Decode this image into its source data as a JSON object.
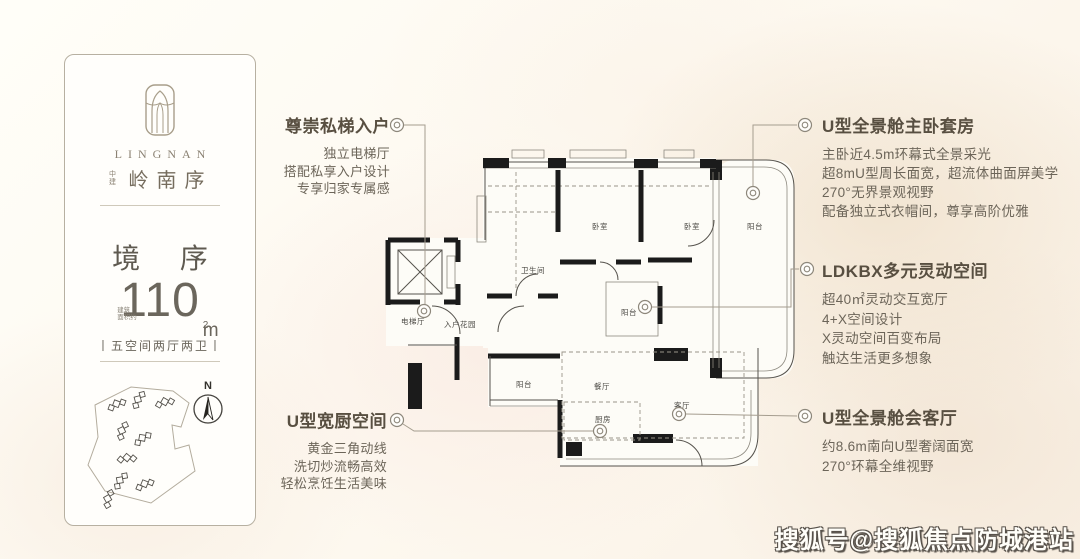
{
  "brand_card": {
    "latin_name": "LINGNAN",
    "brand_prefix": "中建",
    "brand_name": "岭南序",
    "series_title": "境 序",
    "area_note_line1": "建筑",
    "area_note_line2": "面积约",
    "area_value": "110",
    "area_unit_letter": "m",
    "area_unit_exp": "2",
    "layout_spec": "丨五空间两厅两卫丨",
    "compass_label": "N"
  },
  "callouts": {
    "private_elevator": {
      "title": "尊崇私梯入户",
      "lines": [
        "独立电梯厅",
        "搭配私享入户设计",
        "专享归家专属感"
      ]
    },
    "master_suite": {
      "title": "U型全景舱主卧套房",
      "lines": [
        "主卧近4.5m环幕式全景采光",
        "超8mU型周长面宽，超流体曲面屏美学",
        "270°无界景观视野",
        "配备独立式衣帽间，尊享高阶优雅"
      ]
    },
    "ldkbx": {
      "title": "LDKBX多元灵动空间",
      "lines": [
        "超40㎡灵动交互宽厅",
        "4+X空间设计",
        "X灵动空间百变布局",
        "触达生活更多想象"
      ]
    },
    "living_room": {
      "title": "U型全景舱会客厅",
      "lines": [
        "约8.6m南向U型奢阔面宽",
        "270°环幕全维视野"
      ]
    },
    "kitchen": {
      "title": "U型宽厨空间",
      "lines": [
        "黄金三角动线",
        "洗切炒流畅高效",
        "轻松烹饪生活美味"
      ]
    }
  },
  "floor_plan": {
    "labels": {
      "elevator_hall": "电梯厅",
      "entry_garden": "入户花园",
      "bathroom": "卫生间",
      "bedroom_1": "卧室",
      "bedroom_2": "卧室",
      "balcony_master": "阳台",
      "balcony_mid": "阳台",
      "balcony_left": "阳台",
      "dining": "餐厅",
      "kitchen": "厨房",
      "living": "客厅"
    }
  },
  "watermark": "搜狐号@搜狐焦点防城港站",
  "colors": {
    "callout_title": "#584f41",
    "callout_body": "#6c6559",
    "wall": "#1b1b1b",
    "leader_line": "#a59d8f",
    "card_border": "#b7b0a1",
    "background_wash": "#f3e4d6"
  }
}
